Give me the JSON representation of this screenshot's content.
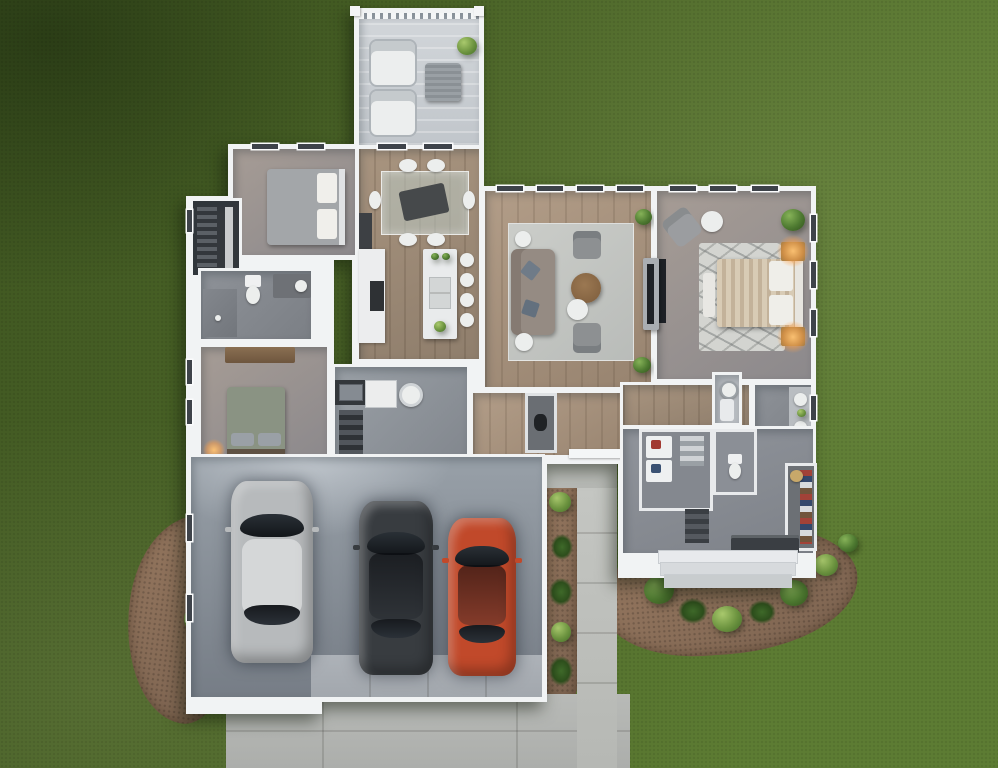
{
  "scene": {
    "type": "3d-floor-plan-top-down-render",
    "description": "Single-story house render viewed from directly above: rear covered patio, two bedrooms, hall bath, kitchen with island, dining area, living room, master suite with bath and walk-in closet, laundry/mudroom entry, attached 3-car garage with driveway, lawn and mulched shrub beds"
  },
  "palette": {
    "grass_dark": "#3f5621",
    "grass_mid": "#4c6628",
    "grass_light": "#5d7c33",
    "wall": "#f1f3f4",
    "deck": "#d2d6da",
    "wood": "#a8947f",
    "mulch": "#95775f",
    "shrub": "#4e7a31",
    "driveway": "#b8bab7",
    "walkway": "#c4c6c2",
    "garage_top": "#98a0a8",
    "garage_bottom": "#767d86",
    "lamp_glow": "#ffb25e",
    "tv_dark": "#1e2126"
  },
  "rooms": [
    {
      "id": "patio",
      "label": "Covered Patio",
      "furniture": [
        "lounge-chair",
        "lounge-chair",
        "outdoor-table",
        "potted-plant"
      ]
    },
    {
      "id": "bedroom-2",
      "label": "Bedroom 2",
      "furniture": [
        "bed-gray-duvet"
      ]
    },
    {
      "id": "closet-2",
      "label": "Closet",
      "furniture": [
        "hanging-clothes"
      ]
    },
    {
      "id": "hall-bathroom",
      "label": "Bathroom",
      "furniture": [
        "toilet",
        "vanity-sink",
        "shower"
      ]
    },
    {
      "id": "bedroom-3",
      "label": "Bedroom 3",
      "furniture": [
        "bed-sage-duvet",
        "dresser",
        "table-lamp"
      ]
    },
    {
      "id": "dining",
      "label": "Dining Area",
      "furniture": [
        "glass-dining-table",
        "dining-chairs-6"
      ]
    },
    {
      "id": "kitchen",
      "label": "Kitchen",
      "furniture": [
        "island-with-sink",
        "bar-stools-4",
        "range-counter",
        "pantry-fridge"
      ]
    },
    {
      "id": "living-room",
      "label": "Living Room",
      "furniture": [
        "sofa",
        "armchairs-2",
        "round-coffee-table",
        "side-tables-3",
        "area-rug",
        "tv-console",
        "potted-plants-2"
      ]
    },
    {
      "id": "master-bedroom",
      "label": "Master Bedroom",
      "furniture": [
        "bed-striped-duvet",
        "nightstands-with-lamps-2",
        "foot-bench",
        "armchair",
        "ottoman",
        "zebra-rug",
        "wall-tv",
        "potted-plant"
      ]
    },
    {
      "id": "laundry",
      "label": "Laundry / Utility",
      "furniture": [
        "utility-sink-counter",
        "washer",
        "vent-fan",
        "linen-shelves"
      ]
    },
    {
      "id": "master-bath",
      "label": "Master Bathroom",
      "furniture": [
        "double-vanity",
        "shower",
        "toilet",
        "water-heater"
      ]
    },
    {
      "id": "walk-in-closet",
      "label": "Walk-in Closet",
      "furniture": [
        "clothes-shelves",
        "basket"
      ]
    },
    {
      "id": "mudroom",
      "label": "Mudroom / Entry",
      "furniture": [
        "coat-bench",
        "shoe-shelf",
        "entry-steps"
      ]
    },
    {
      "id": "garage",
      "label": "3-Car Garage",
      "furniture": []
    }
  ],
  "garage": {
    "cars": [
      {
        "name": "silver-wagon",
        "color": "#b7babc"
      },
      {
        "name": "charcoal-sedan",
        "color": "#383c40"
      },
      {
        "name": "red-sedan",
        "color": "#c1492a"
      }
    ]
  },
  "landscape": {
    "elements": [
      "lawn",
      "mulch-bed-southwest",
      "mulch-bed-entry",
      "mulch-strip-garage",
      "shrubs",
      "driveway",
      "front-walkway",
      "door-walk"
    ]
  }
}
